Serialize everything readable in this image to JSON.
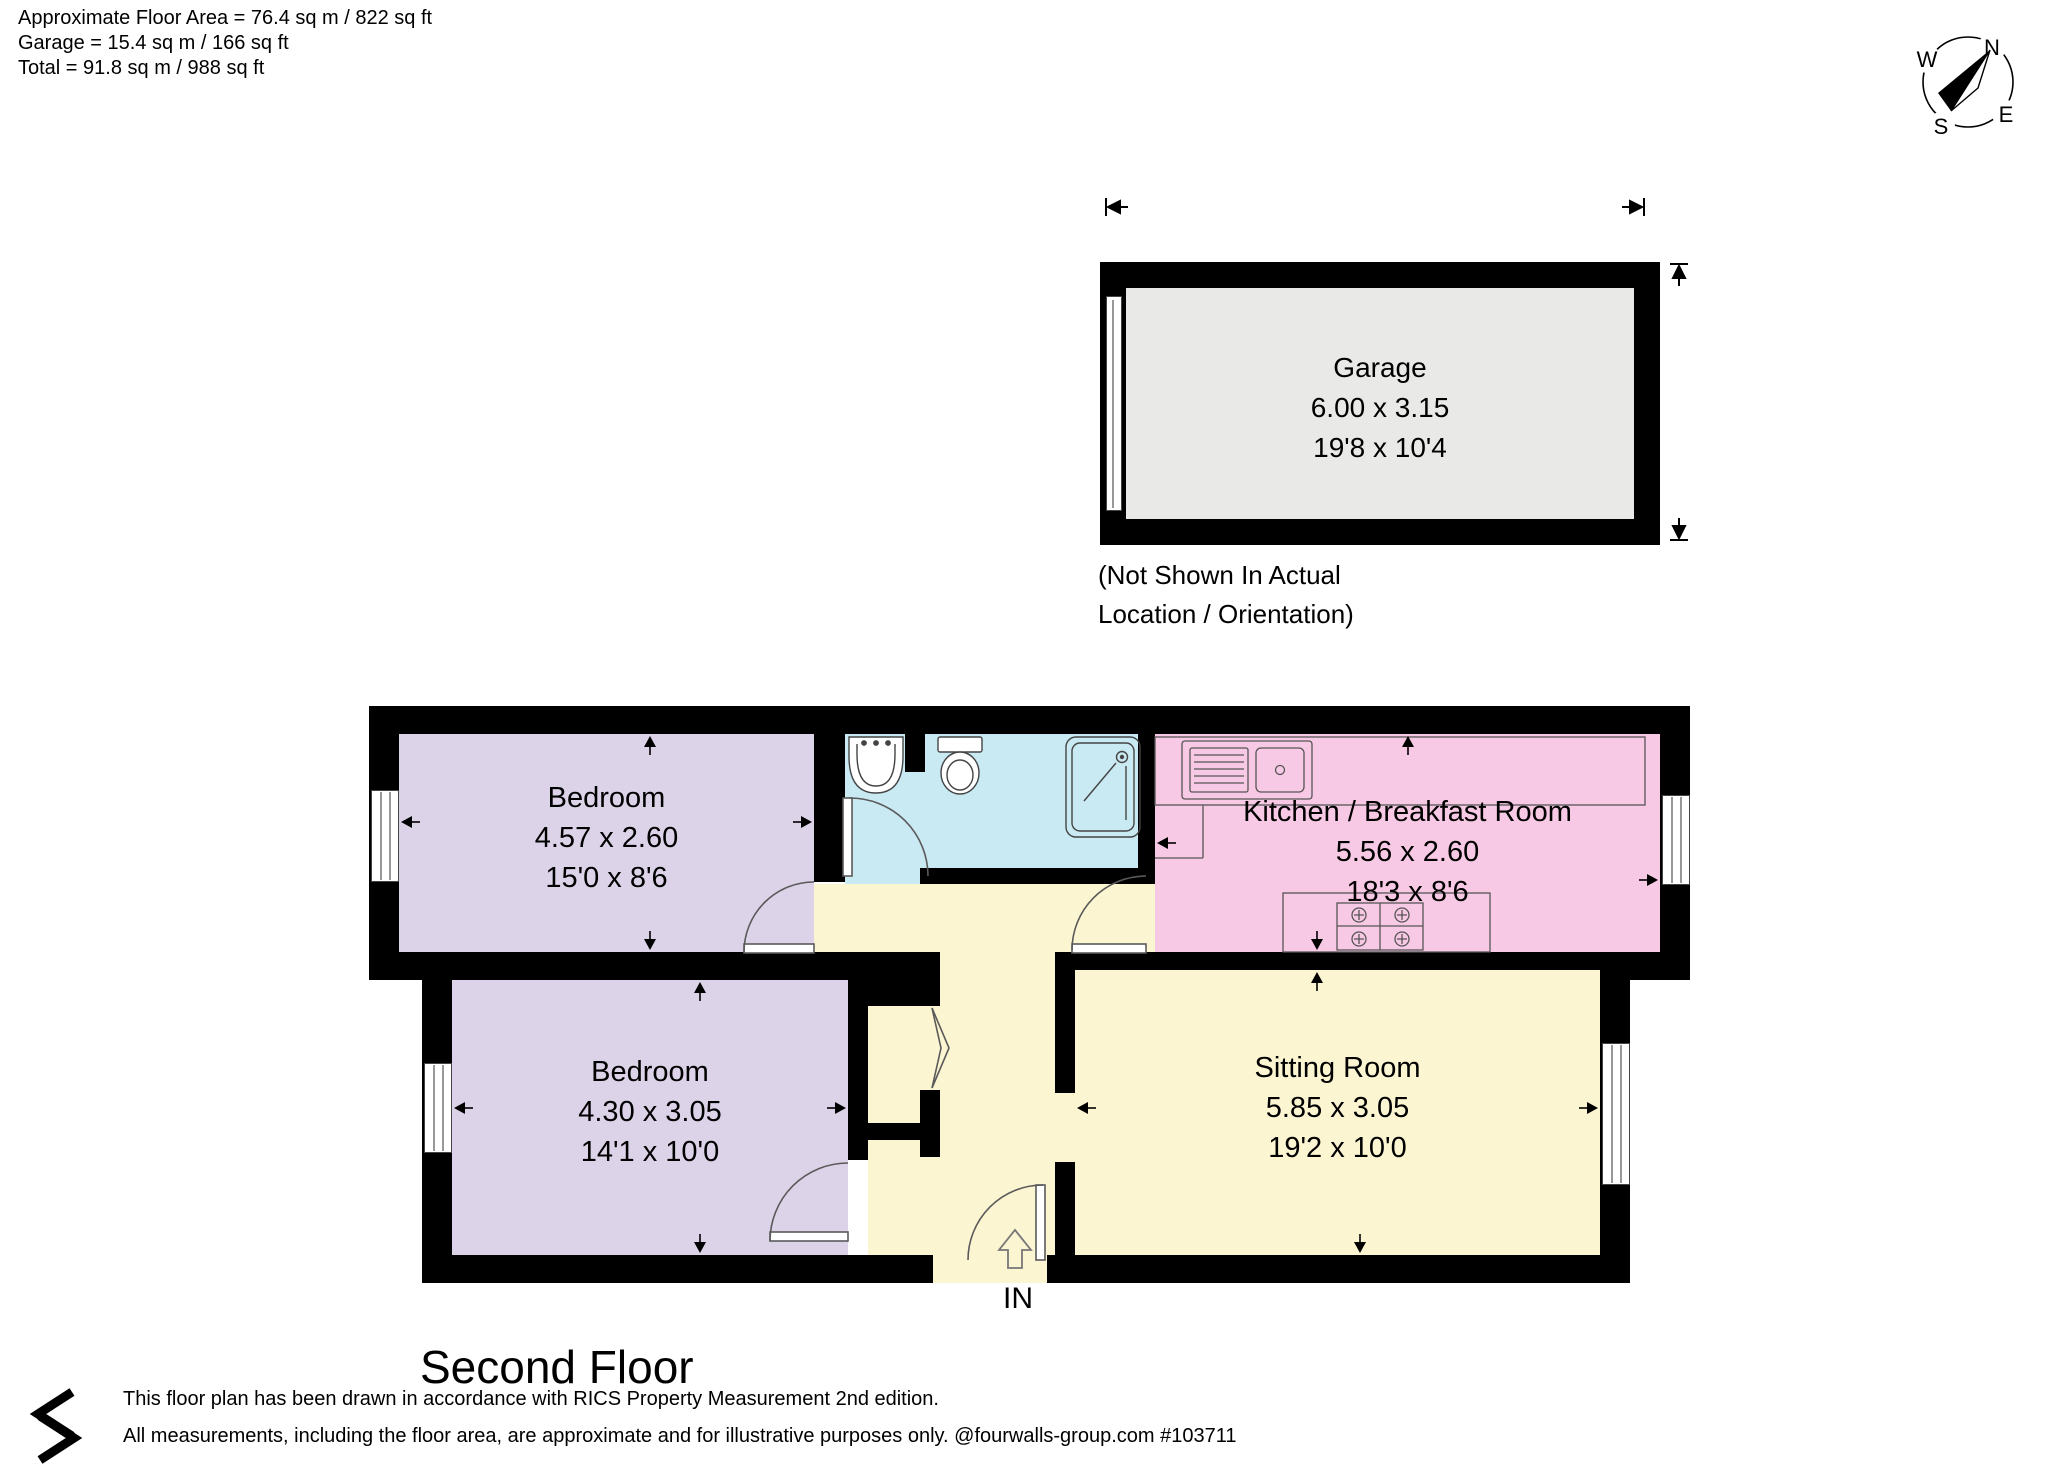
{
  "header": {
    "line1": "Approximate Floor Area = 76.4 sq m / 822 sq ft",
    "line2": "Garage = 15.4 sq m / 166 sq ft",
    "line3": "Total = 91.8 sq m / 988 sq ft"
  },
  "compass": {
    "n": "N",
    "e": "E",
    "s": "S",
    "w": "W"
  },
  "garage": {
    "name": "Garage",
    "metric": "6.00 x 3.15",
    "imperial": "19'8 x 10'4",
    "note_line1": "(Not Shown In Actual",
    "note_line2": "Location / Orientation)"
  },
  "rooms": {
    "bedroom1": {
      "name": "Bedroom",
      "metric": "4.57 x 2.60",
      "imperial": "15'0 x 8'6"
    },
    "bedroom2": {
      "name": "Bedroom",
      "metric": "4.30 x 3.05",
      "imperial": "14'1 x 10'0"
    },
    "kitchen": {
      "name": "Kitchen / Breakfast Room",
      "metric": "5.56 x 2.60",
      "imperial": "18'3 x 8'6"
    },
    "sitting": {
      "name": "Sitting Room",
      "metric": "5.85 x 3.05",
      "imperial": "19'2 x 10'0"
    }
  },
  "entrance": {
    "label": "IN"
  },
  "floor_title": "Second Floor",
  "footer": {
    "line1": "This floor plan has been drawn in accordance with RICS Property Measurement 2nd edition.",
    "line2": "All measurements, including the floor area, are approximate and for illustrative purposes only. @fourwalls-group.com #103711"
  },
  "colors": {
    "bedroom": "#ddd3e8",
    "bathroom": "#c9e9f3",
    "kitchen": "#f8c9e4",
    "hall_sitting": "#fbf5d1",
    "garage": "#e9e9e7",
    "wall": "#000000"
  }
}
